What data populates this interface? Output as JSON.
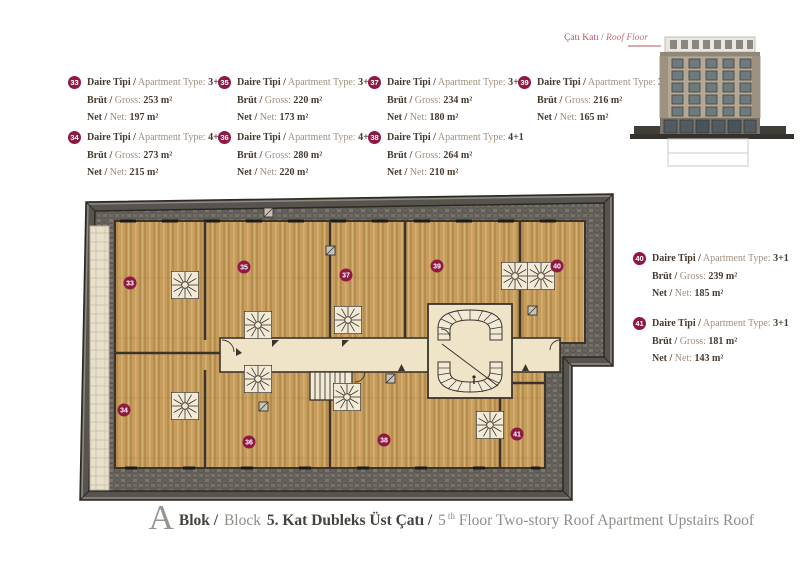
{
  "labels": {
    "type_tr": "Daire Tipi /",
    "type_en": "Apartment Type:",
    "gross_tr": "Brüt /",
    "gross_en": "Gross:",
    "net_tr": "Net /",
    "net_en": "Net:"
  },
  "apartments": [
    {
      "no": "33",
      "type": "3+1",
      "gross": "253 m²",
      "net": "197 m²"
    },
    {
      "no": "34",
      "type": "4+1",
      "gross": "273 m²",
      "net": "215 m²"
    },
    {
      "no": "35",
      "type": "3+1",
      "gross": "220 m²",
      "net": "173 m²"
    },
    {
      "no": "36",
      "type": "4+1",
      "gross": "280 m²",
      "net": "220 m²"
    },
    {
      "no": "37",
      "type": "3+1",
      "gross": "234 m²",
      "net": "180 m²"
    },
    {
      "no": "38",
      "type": "4+1",
      "gross": "264 m²",
      "net": "210 m²"
    },
    {
      "no": "39",
      "type": "3+1",
      "gross": "216 m²",
      "net": "165 m²"
    },
    {
      "no": "40",
      "type": "3+1",
      "gross": "239 m²",
      "net": "185 m²"
    },
    {
      "no": "41",
      "type": "3+1",
      "gross": "181 m²",
      "net": "143 m²"
    }
  ],
  "elevation": {
    "label_tr": "Çatı Katı /",
    "label_en": "Roof Floor"
  },
  "title": {
    "letter": "A",
    "blok_tr": "Blok /",
    "blok_en": "Block",
    "floor_tr": "5. Kat Dubleks Üst Çatı /",
    "floor_en_num": "5",
    "floor_en_sup": "th",
    "floor_en_rest": " Floor Two-story Roof Apartment Upstairs Roof"
  },
  "colors": {
    "badge": "#8e1945",
    "accent_red": "#b5505f",
    "wood": "#c69d5c",
    "stone": "#6e6a63",
    "wall": "#57534e",
    "corridor": "#efe4c8"
  }
}
